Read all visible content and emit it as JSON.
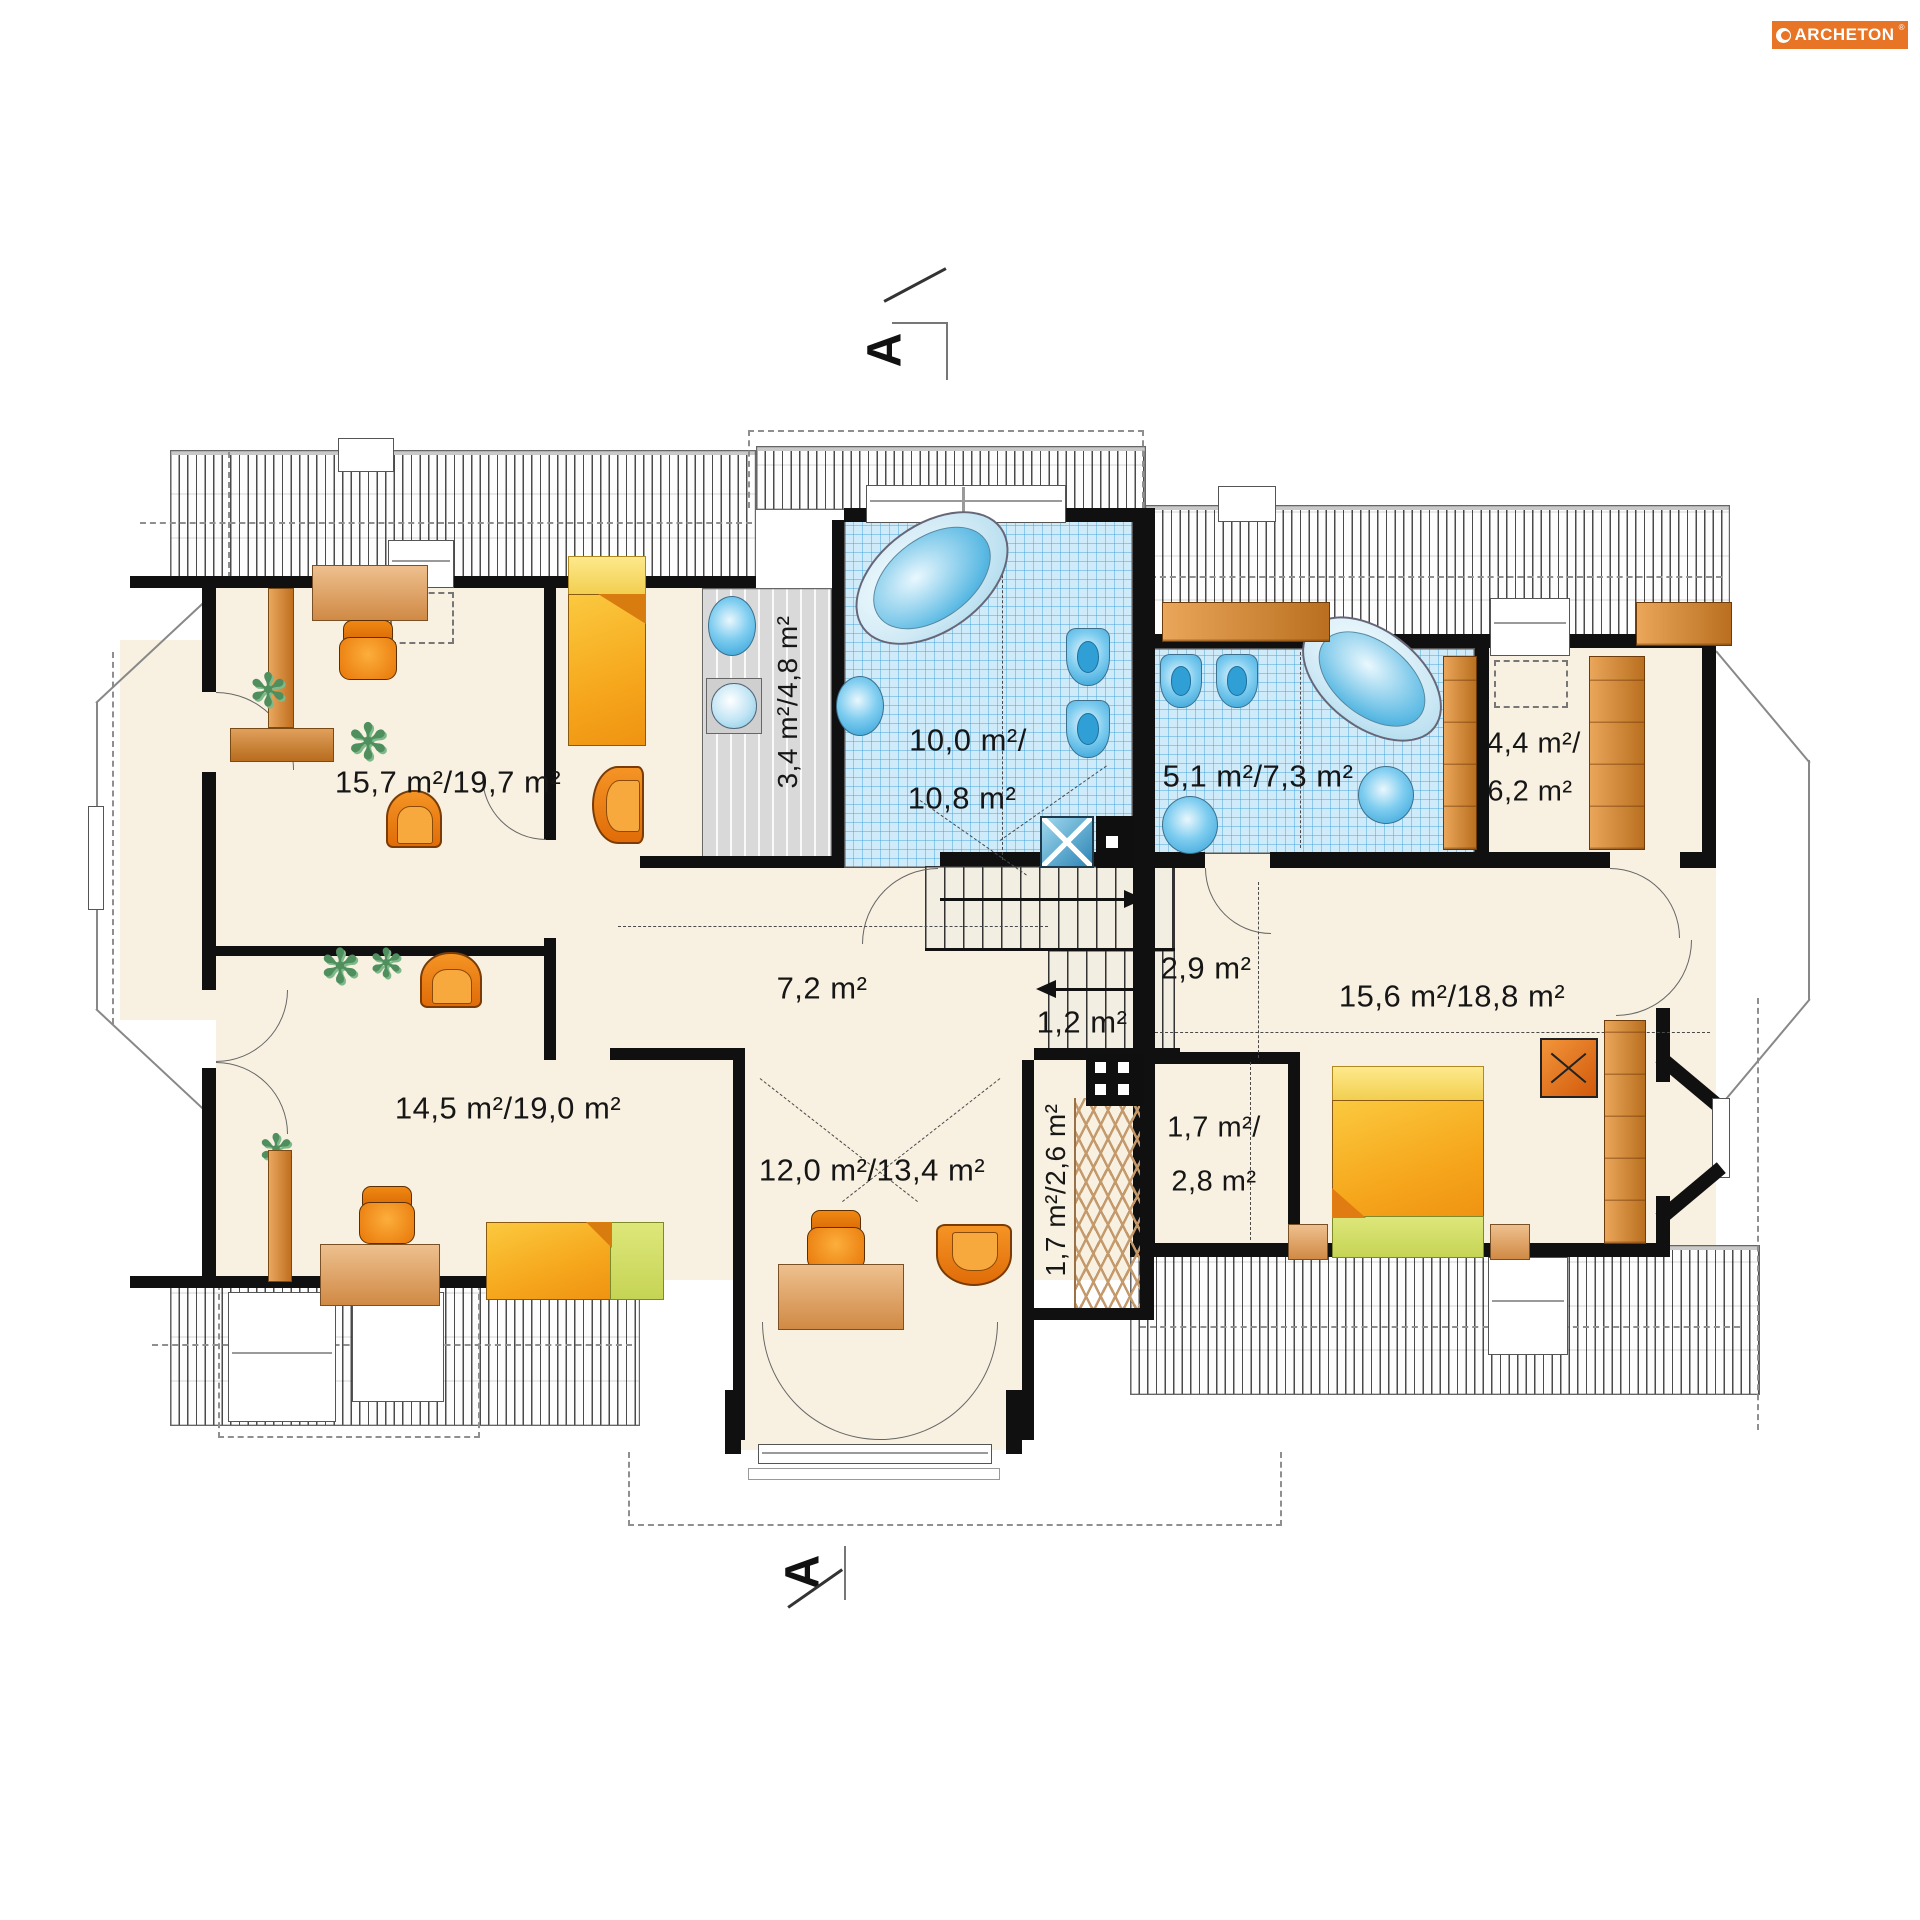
{
  "brand": {
    "name": "ARCHETON",
    "reg": "®"
  },
  "section_markers": {
    "top": "A",
    "bottom": "A"
  },
  "rooms": {
    "top_left": {
      "area": "15,7 m²/19,7 m²"
    },
    "laundry": {
      "area": "3,4 m²/4,8 m²"
    },
    "bath_main": {
      "line1": "10,0 m²/",
      "line2": "10,8 m²"
    },
    "bath_right": {
      "area": "5,1 m²/7,3 m²"
    },
    "closet_right": {
      "line1": "4,4 m²/",
      "line2": "6,2 m²"
    },
    "hall": {
      "area": "7,2 m²"
    },
    "landing": {
      "area": "2,9 m²"
    },
    "under_stairs": {
      "area": "1,2 m²"
    },
    "bedroom_right": {
      "area": "15,6 m²/18,8 m²"
    },
    "bottom_left": {
      "area": "14,5 m²/19,0 m²"
    },
    "bottom_center": {
      "area": "12,0 m²/13,4 m²"
    },
    "wardrobe_center": {
      "area": "1,7 m²/2,6 m²"
    },
    "closet_bedroom": {
      "line1": "1,7 m²/",
      "line2": "2,8 m²"
    }
  },
  "colors": {
    "accent": "#e87425",
    "wall": "#101010",
    "floor": "#f8f1e1",
    "tile": "#cfeaf8",
    "fixture": "#3aabdf"
  }
}
